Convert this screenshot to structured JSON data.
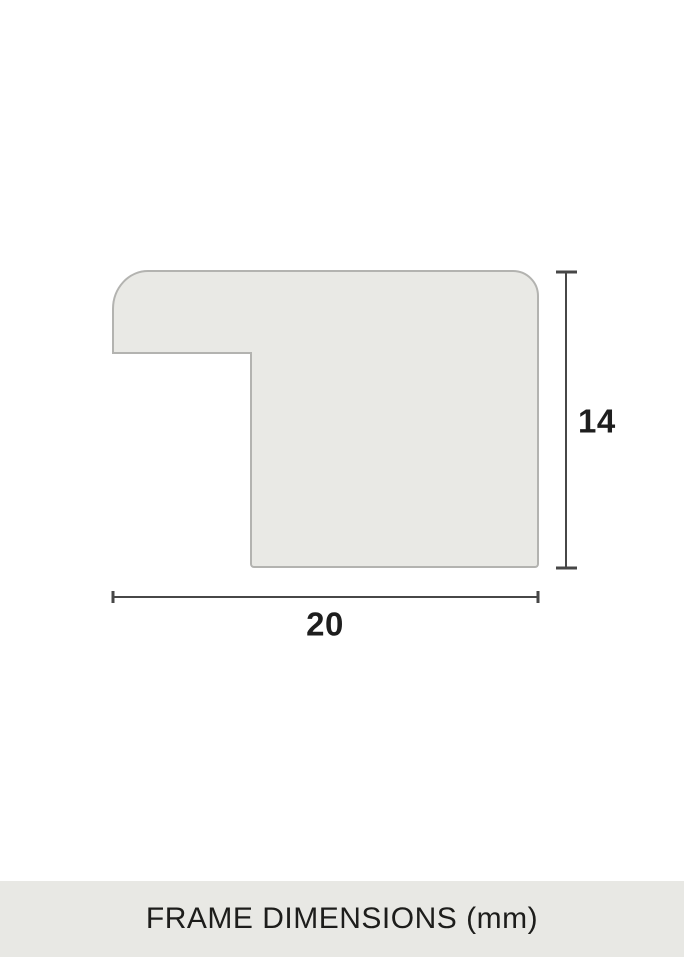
{
  "diagram": {
    "caption": "FRAME DIMENSIONS (mm)",
    "unit": "mm",
    "width_label": "20",
    "height_label": "14",
    "subject": "picture-frame moulding profile cross-section",
    "colors": {
      "background": "#ffffff",
      "profile_fill": "#e9e9e5",
      "profile_stroke": "#b3b3b0",
      "dimension_line": "#474747",
      "label_text": "#1e1e1e",
      "caption_bg": "#e8e8e4",
      "caption_text": "#1d1d1b"
    }
  }
}
